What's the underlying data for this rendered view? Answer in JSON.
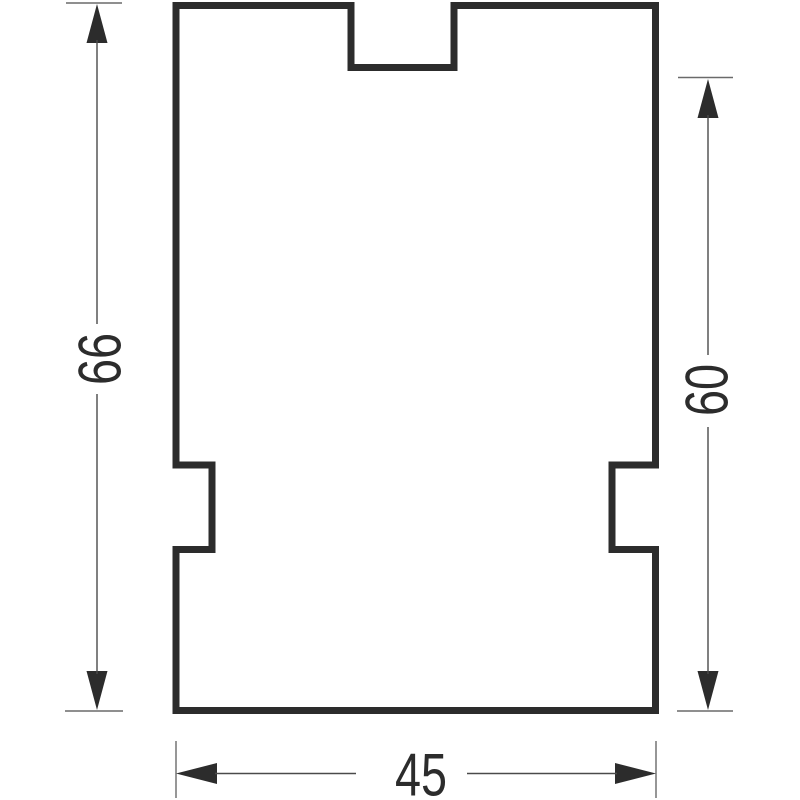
{
  "drawing": {
    "kind": "technical-dimension-drawing",
    "description": "Rectangular profile cross-section with a centered notch on the top edge and one small notch on each side edge",
    "background_color": "#ffffff",
    "outline_color": "#2c2c2c",
    "dimension_line_color": "#4a4a4a",
    "extension_line_color": "#6a6a6a",
    "dimensions": [
      {
        "id": "left_height",
        "label": "66",
        "orientation": "vertical",
        "side": "left",
        "measures": "total height of profile"
      },
      {
        "id": "right_height",
        "label": "60",
        "orientation": "vertical",
        "side": "right",
        "measures": "height from below top notch to bottom"
      },
      {
        "id": "bottom_width",
        "label": "45",
        "orientation": "horizontal",
        "side": "bottom",
        "measures": "total width of profile"
      }
    ],
    "labels": {
      "left_height": "66",
      "right_height": "60",
      "bottom_width": "45"
    }
  }
}
